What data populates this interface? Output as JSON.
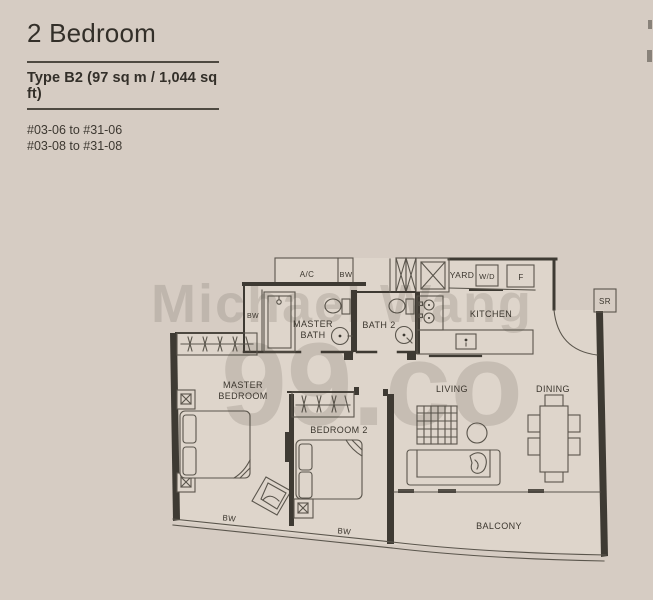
{
  "page": {
    "background": "#d6ccc3"
  },
  "header": {
    "title": "2 Bedroom",
    "subtitle": "Type B2 (97 sq m / 1,044 sq ft)",
    "units": [
      "#03-06 to #31-06",
      "#03-08 to #31-08"
    ]
  },
  "watermark": {
    "line1": "Michael Wang",
    "line2": "99.co",
    "color": "#453c33"
  },
  "floorplan": {
    "wall_color": "#3e3a33",
    "furniture_color": "#5a554c",
    "interior_fill": "#ded5cb",
    "labels": [
      {
        "id": "ac",
        "text": "A/C",
        "x": 307,
        "y": 277,
        "size": 8
      },
      {
        "id": "bw-ledge",
        "text": "BW",
        "x": 346,
        "y": 277,
        "size": 7.5
      },
      {
        "id": "yard",
        "text": "YARD",
        "x": 462,
        "y": 278,
        "size": 8.5
      },
      {
        "id": "wd",
        "text": "W/D",
        "x": 487,
        "y": 279,
        "size": 7.5
      },
      {
        "id": "fridge",
        "text": "F",
        "x": 521,
        "y": 280,
        "size": 8
      },
      {
        "id": "sr",
        "text": "SR",
        "x": 605,
        "y": 304,
        "size": 8
      },
      {
        "id": "kitchen",
        "text": "KITCHEN",
        "x": 491,
        "y": 317,
        "size": 9
      },
      {
        "id": "bath2",
        "text": "BATH 2",
        "x": 379,
        "y": 328,
        "size": 9
      },
      {
        "id": "master-bath-1",
        "text": "MASTER",
        "x": 313,
        "y": 327,
        "size": 9
      },
      {
        "id": "master-bath-2",
        "text": "BATH",
        "x": 313,
        "y": 338,
        "size": 9
      },
      {
        "id": "bw-master-bath",
        "text": "BW",
        "x": 253,
        "y": 318,
        "size": 7
      },
      {
        "id": "master-bedroom-1",
        "text": "MASTER",
        "x": 243,
        "y": 388,
        "size": 9
      },
      {
        "id": "master-bedroom-2",
        "text": "BEDROOM",
        "x": 243,
        "y": 399,
        "size": 9
      },
      {
        "id": "bedroom2",
        "text": "BEDROOM 2",
        "x": 339,
        "y": 433,
        "size": 9
      },
      {
        "id": "living",
        "text": "LIVING",
        "x": 452,
        "y": 392,
        "size": 9
      },
      {
        "id": "dining",
        "text": "DINING",
        "x": 553,
        "y": 392,
        "size": 9
      },
      {
        "id": "balcony",
        "text": "BALCONY",
        "x": 499,
        "y": 529,
        "size": 9
      },
      {
        "id": "bw-bay-1",
        "text": "BW",
        "x": 229,
        "y": 521,
        "size": 8,
        "rotate": 6
      },
      {
        "id": "bw-bay-2",
        "text": "BW",
        "x": 344,
        "y": 534,
        "size": 8,
        "rotate": 6
      }
    ]
  }
}
